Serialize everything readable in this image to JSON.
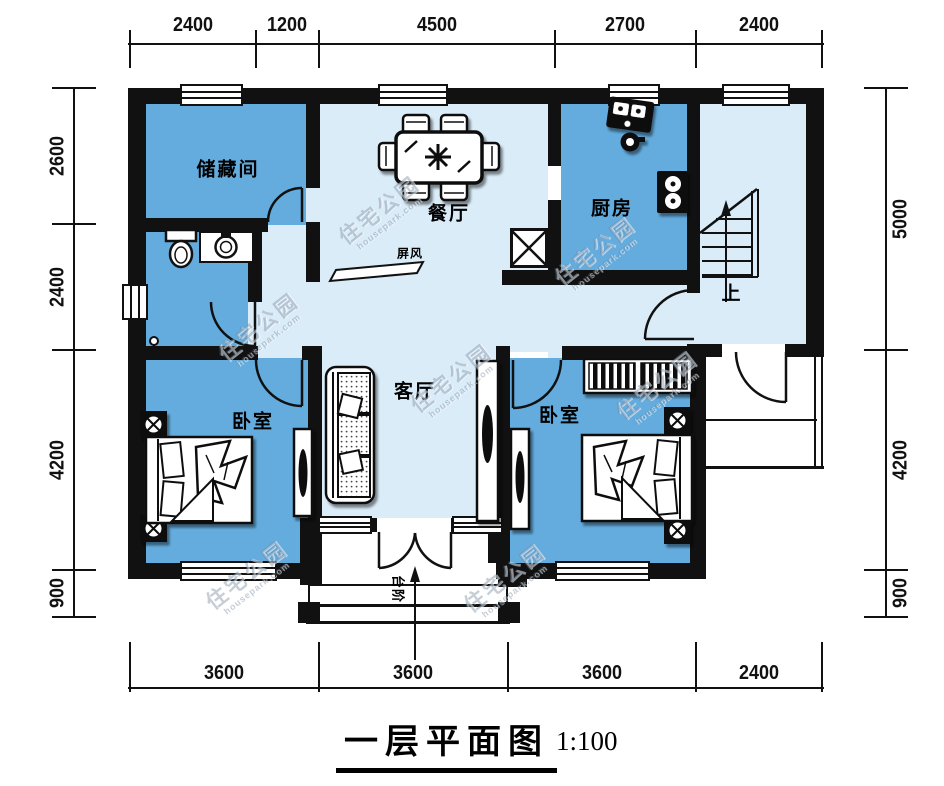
{
  "title": {
    "text": "一层平面图",
    "scale": "1:100"
  },
  "rooms": {
    "storage": "储藏间",
    "dining": "餐厅",
    "kitchen": "厨房",
    "living": "客厅",
    "bedroom_left": "卧室",
    "bedroom_right": "卧室",
    "screen": "屏风",
    "stairs_up": "上",
    "entry_steps": "台阶"
  },
  "dimensions": {
    "top": [
      "2400",
      "1200",
      "4500",
      "2700",
      "2400"
    ],
    "bottom": [
      "3600",
      "3600",
      "3600",
      "2400"
    ],
    "left": [
      "2600",
      "2400",
      "4200",
      "900"
    ],
    "right": [
      "5000",
      "4200",
      "900"
    ]
  },
  "watermark": {
    "text": "住宅公园",
    "subtext": "housepark.com"
  },
  "colors": {
    "room_fill": "#64acde",
    "hall_fill": "#d9ecf8",
    "wall": "#111111"
  }
}
